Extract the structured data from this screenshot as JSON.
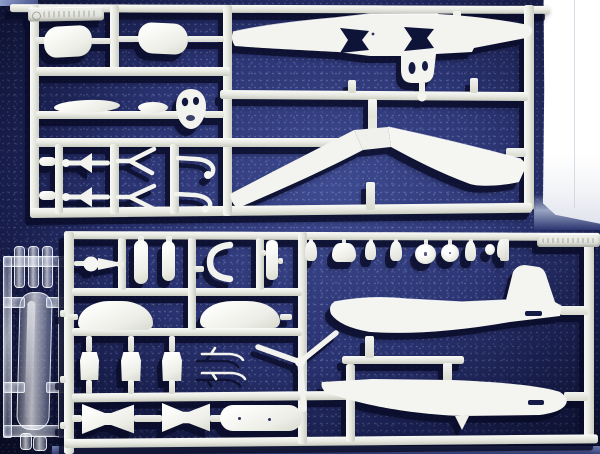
{
  "scene": {
    "subject": "Photograph of plastic model aircraft kit sprues laid on a dark blue speckled background",
    "setting": "Two white injection-moulded sprues, one small clear sprue, bright over-exposed paper visible at upper right",
    "lighting": "Hard sunlight from upper right casting sharp navy shadows down and to the left",
    "palette": {
      "background_center": "#3e4b90",
      "background_mid": "#2c3574",
      "background_edge": "#131a40",
      "plastic_white": "#f3f4f0",
      "runner_grey": "#e0e2da",
      "shadow_navy": "#090c26",
      "overexposed_paper": "#fefefe",
      "clear_plastic_tint": "#d9e3f7",
      "bottom_strip": "#6a77ab"
    },
    "sprue_top": {
      "label": "White sprue A - wings, tanks and small fittings",
      "parts": [
        "embossed maker tag (illegible)",
        "drop tank half left",
        "drop tank half right",
        "one-piece upper wing with bow-tie cut-outs",
        "port lower wing panel",
        "starboard lower wing panel",
        "horizontal stabilizer large",
        "horizontal stabilizer small",
        "engine cowl front with openings",
        "mounting peg",
        "finned dart part",
        "V landing-gear strut",
        "tail hook"
      ]
    },
    "sprue_bottom": {
      "label": "White sprue B - fuselage halves, propeller and interior",
      "parts": [
        "embossed part-number tag (illegible)",
        "spinner with ball joint",
        "exhaust stack",
        "curved intake lip",
        "slotted brace",
        "engine cowl half",
        "crew seat",
        "whip aerial",
        "propeller blade pair",
        "centre-section plate",
        "main wheel",
        "hub caps and pegs",
        "three-blade propeller",
        "upper fuselage half with tail fin",
        "lower fuselage half"
      ]
    },
    "sprue_clear": {
      "label": "Clear sprue - canopy and lenses",
      "parts": [
        "cockpit canopy",
        "clear lens stalk",
        "small clear lights"
      ]
    }
  }
}
